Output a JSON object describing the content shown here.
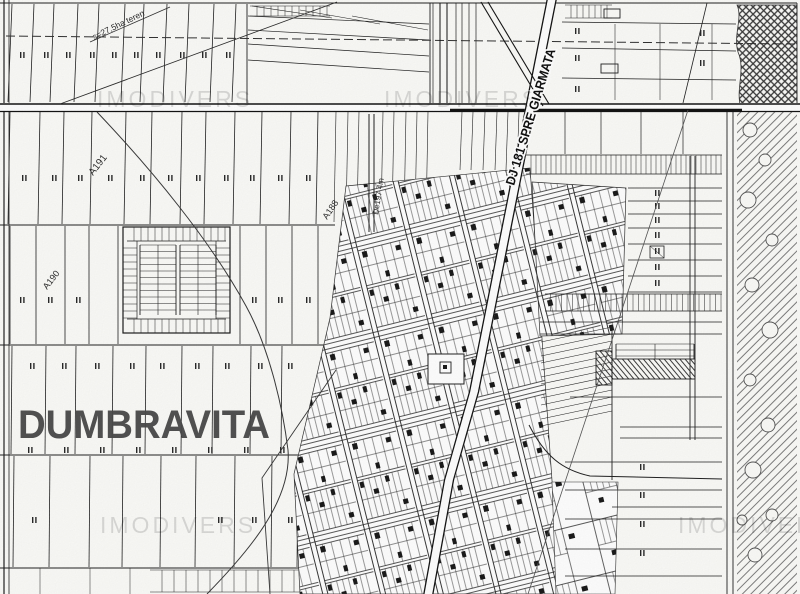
{
  "window": {
    "width": 800,
    "height": 594
  },
  "map": {
    "kind": "scanned cadastral / parcel plan",
    "town_label": "DUMBRAVITA",
    "road_label": "DJ 181 SPRE GIARMATA",
    "watermark_text": "IMODIVERS",
    "watermarks": [
      {
        "x": 97,
        "y": 107
      },
      {
        "x": 384,
        "y": 107
      },
      {
        "x": 100,
        "y": 533
      },
      {
        "x": 678,
        "y": 533
      }
    ],
    "parcel_labels": [
      {
        "text": "A191",
        "x": 93,
        "y": 176,
        "rot": -52,
        "size": 10
      },
      {
        "text": "A190",
        "x": 47,
        "y": 290,
        "rot": -52,
        "size": 9
      },
      {
        "text": "A188",
        "x": 327,
        "y": 220,
        "rot": -56,
        "size": 9
      },
      {
        "text": "De197 4m",
        "x": 378,
        "y": 215,
        "rot": -81,
        "size": 8
      },
      {
        "text": "s=27,5ha teren",
        "x": 94,
        "y": 40,
        "rot": -26,
        "size": 8.5
      }
    ],
    "colors": {
      "paper": "#fbfbf8",
      "ink": "#1c1c1c",
      "ink_soft": "#555555",
      "hatch": "#6f6f6f",
      "hatch_dark": "#3a3a3a",
      "town_label": "#4a4a4a"
    }
  }
}
